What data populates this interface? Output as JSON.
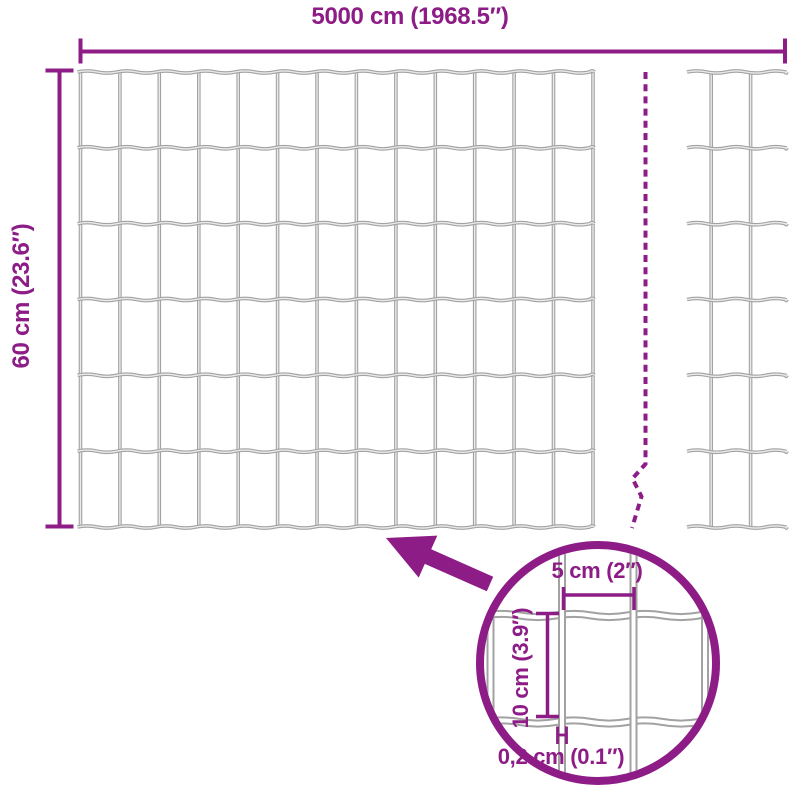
{
  "title": "Garden fence mesh dimension diagram",
  "labels": {
    "total_width": "5000 cm (1968.5″)",
    "total_height": "60 cm (23.6″)"
  },
  "detail": {
    "mesh_width": "5 cm (2″)",
    "mesh_height": "10 cm (3.9″)",
    "wire_thickness": "0,2 cm (0.1″)"
  },
  "icons": {
    "arrow": "thick-arrow-pointing-up-left",
    "magnifier": "zoom-detail-circle",
    "break_line": "dashed-continuation-break"
  },
  "colors": {
    "accent": "#8d1c86",
    "wire": "#a2a2a2",
    "wire_highlight": "#eaeaea",
    "background": "#ffffff"
  }
}
